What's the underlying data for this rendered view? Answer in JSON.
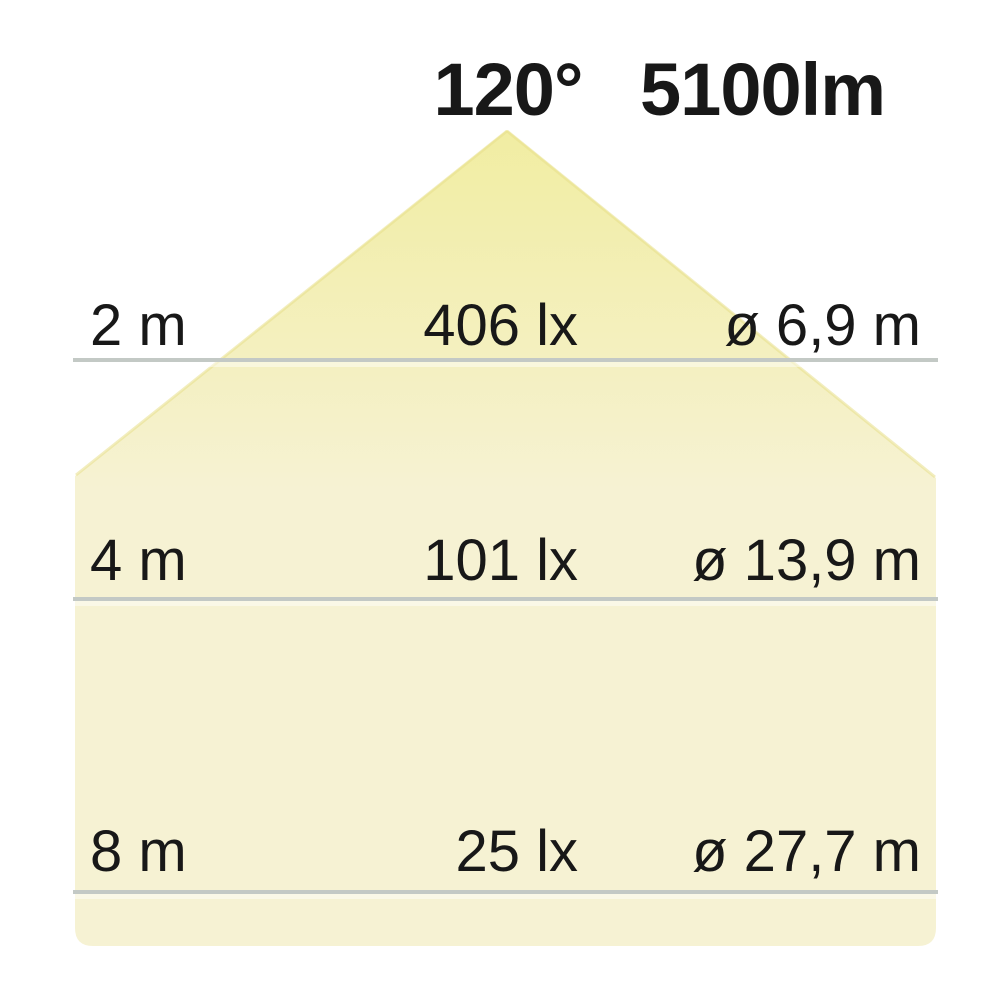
{
  "header": {
    "beam_angle": "120°",
    "luminous_flux": "5100lm"
  },
  "rows": [
    {
      "distance": "2 m",
      "illuminance": "406 lx",
      "diameter": "ø 6,9 m"
    },
    {
      "distance": "4 m",
      "illuminance": "101 lx",
      "diameter": "ø 13,9 m"
    },
    {
      "distance": "8 m",
      "illuminance": "25 lx",
      "diameter": "ø 27,7 m"
    }
  ],
  "colors": {
    "beam_apex": "#f1eda2",
    "beam_mid": "#f4f0c0",
    "beam_body": "#f6f2d3",
    "beam_edge": "#e8e08c",
    "distance_line": "#c3c9c5",
    "text": "#181818",
    "background": "#ffffff"
  }
}
